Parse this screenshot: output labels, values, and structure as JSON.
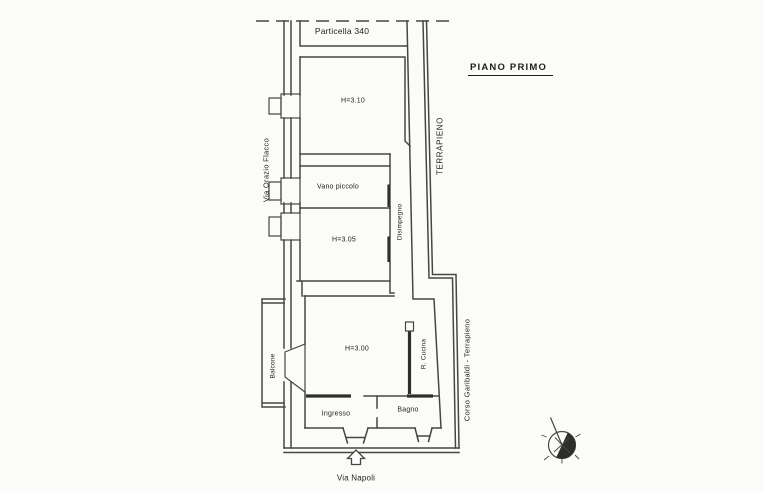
{
  "colors": {
    "paper": "#fbfbf9",
    "ink": "#47463f",
    "ink_dark": "#2e2e2c",
    "text": "#1f1f1e"
  },
  "title": {
    "floor_label": "PIANO PRIMO"
  },
  "parcel": {
    "label": "Particella 340"
  },
  "streets": {
    "left": "Via Orazio Flacco",
    "right_upper": "TERRAPIENO",
    "right_lower": "Corso Garibaldi - Terrapieno",
    "bottom": "Via Napoli"
  },
  "rooms": {
    "bedroom_top": {
      "label": "H=3.10"
    },
    "vano_piccolo": {
      "label": "Vano piccolo"
    },
    "disimpegno": {
      "label": "Disimpegno"
    },
    "bedroom_mid": {
      "label": "H=3.05"
    },
    "living": {
      "label": "H=3.00"
    },
    "cucina": {
      "label": "R. Cucina"
    },
    "balcone": {
      "label": "Balcone"
    },
    "ingresso": {
      "label": "Ingresso"
    },
    "bagno": {
      "label": "Bagno"
    }
  },
  "icons": {
    "compass": "compass-rose",
    "entrance_arrow": "entrance-arrow-up"
  }
}
